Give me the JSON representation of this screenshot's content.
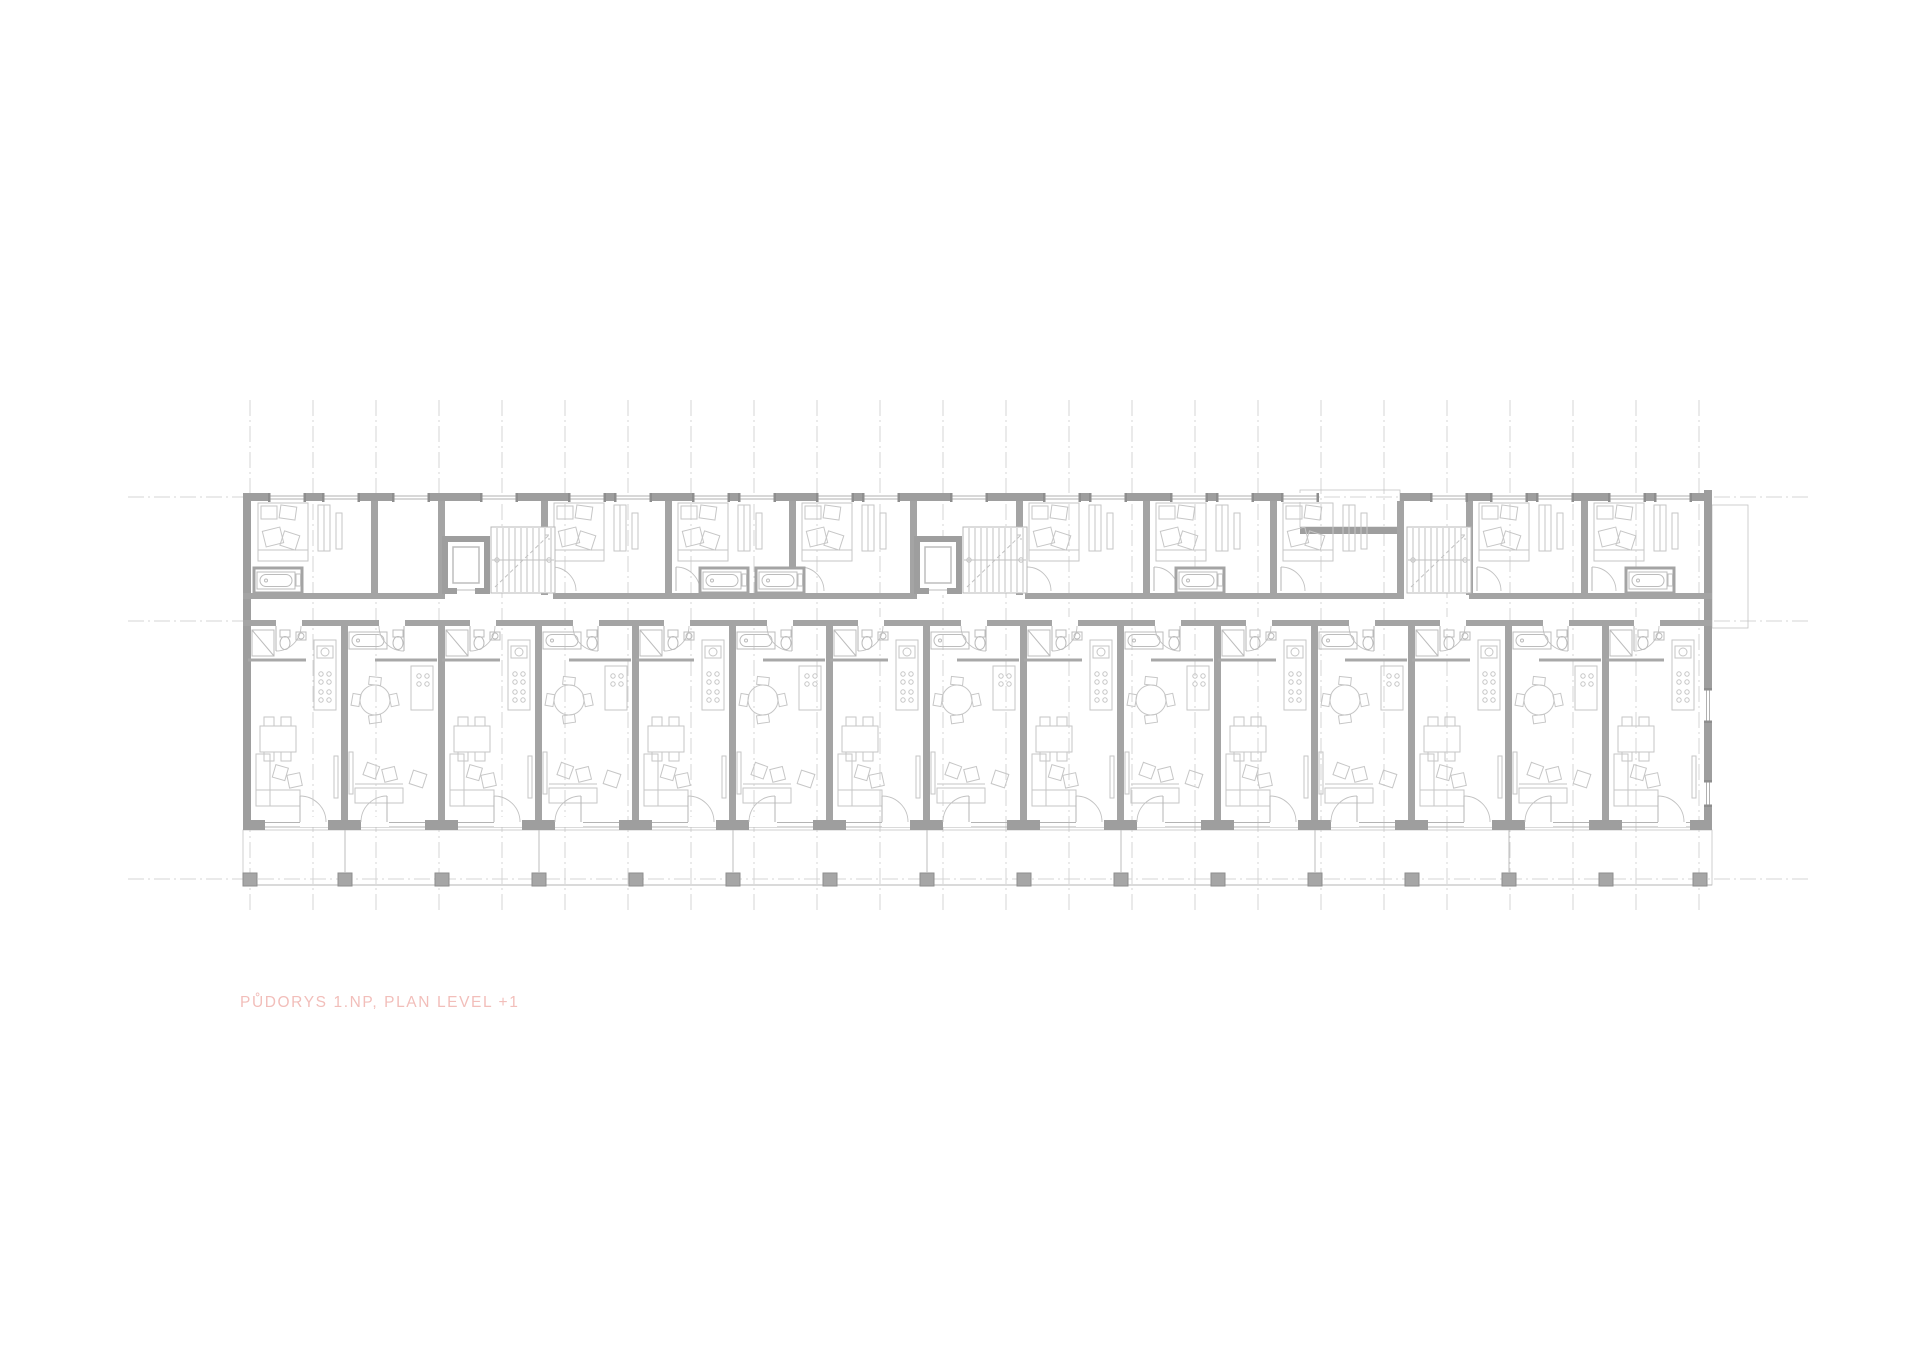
{
  "document": {
    "kind": "architectural floor plan drawing",
    "level_shown": "+1"
  },
  "plan_label": {
    "text": "PŮDORYS 1.NP, PLAN LEVEL +1",
    "color": "#f2beba"
  },
  "palette": {
    "background": "#ffffff",
    "wall_outer": "#9e9e9e",
    "wall_inner": "#a4a4a4",
    "furniture_line": "#c6c6c6",
    "fixture_line": "#bcbcbc",
    "axis_line": "#d4d4d4",
    "hatch_line": "#d8d8d8",
    "window_jamb_dark": "#8e8e8e",
    "label_pink": "#f2beba"
  },
  "plan_geometry": {
    "stamps": [
      {
        "template": "tpl-vaxis",
        "layer": "layer-axes",
        "positions": [
          [
            250,
            0
          ],
          [
            313,
            0
          ],
          [
            376,
            0
          ],
          [
            439,
            0
          ],
          [
            502,
            0
          ],
          [
            565,
            0
          ],
          [
            628,
            0
          ],
          [
            691,
            0
          ],
          [
            754,
            0
          ],
          [
            817,
            0
          ],
          [
            880,
            0
          ],
          [
            943,
            0
          ],
          [
            1006,
            0
          ],
          [
            1069,
            0
          ],
          [
            1132,
            0
          ],
          [
            1195,
            0
          ],
          [
            1258,
            0
          ],
          [
            1321,
            0
          ],
          [
            1384,
            0
          ],
          [
            1447,
            0
          ],
          [
            1510,
            0
          ],
          [
            1573,
            0
          ],
          [
            1636,
            0
          ],
          [
            1699,
            0
          ]
        ]
      },
      {
        "template": "tpl-haxis",
        "layer": "layer-axes",
        "positions": [
          [
            0,
            497
          ],
          [
            0,
            621
          ],
          [
            0,
            879
          ]
        ]
      },
      {
        "template": "tpl-module-a",
        "layer": "layer-fixtures",
        "positions": [
          [
            248,
            626
          ],
          [
            442,
            626
          ],
          [
            636,
            626
          ],
          [
            830,
            626
          ],
          [
            1024,
            626
          ],
          [
            1218,
            626
          ],
          [
            1412,
            626
          ],
          [
            1606,
            626
          ]
        ]
      },
      {
        "template": "tpl-module-b",
        "layer": "layer-fixtures",
        "positions": [
          [
            345,
            626
          ],
          [
            539,
            626
          ],
          [
            733,
            626
          ],
          [
            927,
            626
          ],
          [
            1121,
            626
          ],
          [
            1315,
            626
          ],
          [
            1509,
            626
          ]
        ]
      },
      {
        "template": "tpl-bedroom",
        "layer": "layer-fixtures",
        "positions": [
          [
            252,
            503
          ],
          [
            548,
            503
          ],
          [
            672,
            503
          ],
          [
            796,
            503
          ],
          [
            1023,
            503
          ],
          [
            1150,
            503
          ],
          [
            1277,
            503
          ],
          [
            1473,
            503
          ],
          [
            1588,
            503
          ]
        ]
      },
      {
        "template": "tpl-tubroom",
        "layer": "layer-fixtures",
        "positions": [
          [
            254,
            568
          ],
          [
            700,
            568
          ],
          [
            756,
            568
          ],
          [
            1176,
            568
          ],
          [
            1626,
            568
          ]
        ]
      },
      {
        "template": "tpl-core",
        "layer": "layer-cores",
        "positions": [
          [
            445,
            527
          ],
          [
            917,
            527
          ]
        ]
      },
      {
        "template": "tpl-stair",
        "layer": "layer-cores",
        "positions": [
          [
            1407,
            527
          ]
        ]
      },
      {
        "template": "tpl-window",
        "layer": "layer-windows",
        "positions": [
          [
            268,
            493
          ],
          [
            322,
            493
          ],
          [
            392,
            493
          ],
          [
            480,
            493
          ],
          [
            568,
            493
          ],
          [
            614,
            493
          ],
          [
            692,
            493
          ],
          [
            738,
            493
          ],
          [
            816,
            493
          ],
          [
            862,
            493
          ],
          [
            950,
            493
          ],
          [
            1043,
            493
          ],
          [
            1089,
            493
          ],
          [
            1170,
            493
          ],
          [
            1216,
            493
          ],
          [
            1281,
            493
          ],
          [
            1430,
            493
          ],
          [
            1490,
            493
          ],
          [
            1536,
            493
          ],
          [
            1608,
            493
          ],
          [
            1654,
            493
          ]
        ]
      },
      {
        "template": "tpl-column",
        "layer": "layer-columns",
        "positions": [
          [
            250,
            879
          ],
          [
            345,
            879
          ],
          [
            442,
            879
          ],
          [
            539,
            879
          ],
          [
            636,
            879
          ],
          [
            733,
            879
          ],
          [
            830,
            879
          ],
          [
            927,
            879
          ],
          [
            1024,
            879
          ],
          [
            1121,
            879
          ],
          [
            1218,
            879
          ],
          [
            1315,
            879
          ],
          [
            1412,
            879
          ],
          [
            1509,
            879
          ],
          [
            1606,
            879
          ],
          [
            1700,
            879
          ]
        ]
      },
      {
        "template": "tpl-tdivider",
        "layer": "layer-columns",
        "positions": [
          [
            345,
            830
          ],
          [
            539,
            830
          ],
          [
            733,
            830
          ],
          [
            927,
            830
          ],
          [
            1121,
            830
          ],
          [
            1315,
            830
          ],
          [
            1509,
            830
          ]
        ]
      }
    ]
  }
}
